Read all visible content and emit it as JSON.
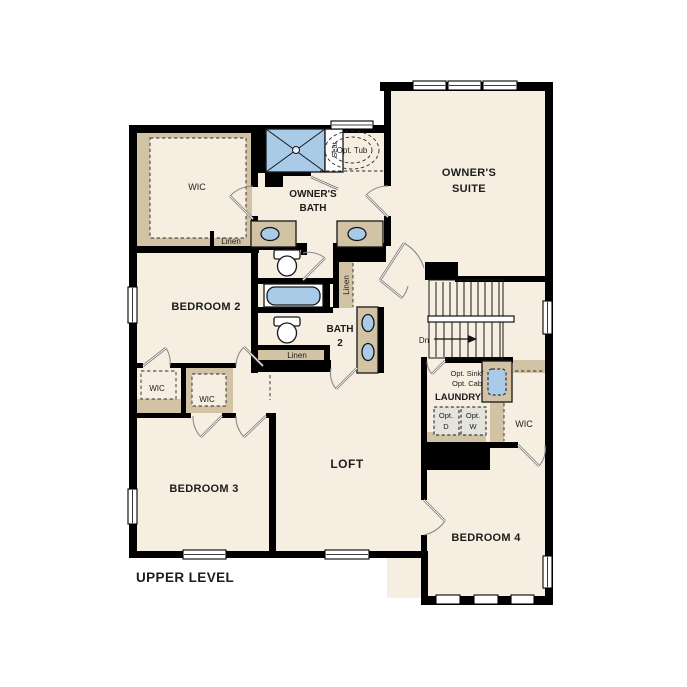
{
  "colors": {
    "bg": "#ffffff",
    "floor": "#f6eee1",
    "wall": "#000000",
    "cabinet": "#d2c3a5",
    "water": "#a9cbe8",
    "text": "#1c1c1c"
  },
  "plan": {
    "title": "UPPER LEVEL",
    "rooms": {
      "owners_suite": {
        "line1": "OWNER'S",
        "line2": "SUITE"
      },
      "owners_bath": {
        "line1": "OWNER'S",
        "line2": "BATH"
      },
      "owners_wic": {
        "label": "WIC"
      },
      "bedroom2": {
        "label": "BEDROOM 2"
      },
      "bedroom2_wic": {
        "label": "WIC"
      },
      "bedroom3": {
        "label": "BEDROOM 3"
      },
      "bedroom3_wic": {
        "label": "WIC"
      },
      "bedroom4": {
        "label": "BEDROOM 4"
      },
      "bedroom4_wic": {
        "label": "WIC"
      },
      "bath2": {
        "line1": "BATH",
        "line2": "2"
      },
      "laundry": {
        "label": "LAUNDRY"
      },
      "loft": {
        "label": "LOFT"
      }
    },
    "features": {
      "linen_owner": "Linen",
      "linen_hall": "Linen",
      "linen_bath2": "Linen",
      "shower_seat": "Seat",
      "opt_tub": "Opt. Tub",
      "opt_sink_line1": "Opt. Sink/",
      "opt_sink_line2": "Opt. Cab",
      "opt_dryer_line1": "Opt.",
      "opt_dryer_line2": "D",
      "opt_washer_line1": "Opt.",
      "opt_washer_line2": "W",
      "stairs_down": "Dn"
    }
  }
}
